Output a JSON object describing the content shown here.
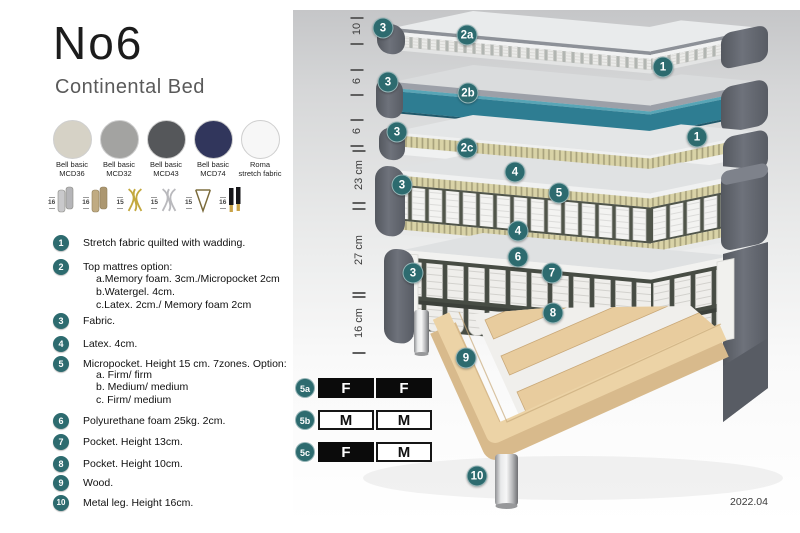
{
  "header": {
    "title": "No6",
    "subtitle": "Continental Bed"
  },
  "swatches": [
    {
      "name": "Bell basic\nMCD36",
      "color": "#d6d2c6",
      "dot": "rgba(255,255,255,0.6)"
    },
    {
      "name": "Bell basic\nMCD32",
      "color": "#a3a3a1",
      "dot": "rgba(255,255,255,0.5)"
    },
    {
      "name": "Bell basic\nMCD43",
      "color": "#55575a",
      "dot": "rgba(255,255,255,0.35)"
    },
    {
      "name": "Bell basic\nMCD74",
      "color": "#31365c",
      "dot": "rgba(255,255,255,0.3)"
    },
    {
      "name": "Roma\nstretch fabric",
      "color": "#f7f7f7",
      "dot": "rgba(220,220,220,0.5)"
    }
  ],
  "legs": [
    {
      "height": "16",
      "type": "cylinder-silver"
    },
    {
      "height": "16",
      "type": "cylinder-bronze"
    },
    {
      "height": "15",
      "type": "twist-gold"
    },
    {
      "height": "15",
      "type": "twist-silver"
    },
    {
      "height": "15",
      "type": "hairpin"
    },
    {
      "height": "16",
      "type": "cone-black-gold"
    }
  ],
  "features": [
    {
      "num": "1",
      "text": "Stretch fabric quilted with wadding.",
      "subs": []
    },
    {
      "num": "2",
      "text": "Top mattres option:",
      "subs": [
        "a.Memory foam. 3cm./Micropocket 2cm",
        "b.Watergel. 4cm.",
        "c.Latex. 2cm./ Memory foam 2cm"
      ]
    },
    {
      "num": "3",
      "text": "Fabric.",
      "subs": []
    },
    {
      "num": "4",
      "text": "Latex. 4cm.",
      "subs": []
    },
    {
      "num": "5",
      "text": "Micropocket. Height 15 cm. 7zones. Option:",
      "subs": [
        "a. Firm/ firm",
        "b. Medium/ medium",
        "c. Firm/ medium"
      ]
    },
    {
      "num": "6",
      "text": "Polyurethane foam 25kg. 2cm.",
      "subs": []
    },
    {
      "num": "7",
      "text": "Pocket. Height 13cm.",
      "subs": []
    },
    {
      "num": "8",
      "text": "Pocket. Height 10cm.",
      "subs": []
    },
    {
      "num": "9",
      "text": "Wood.",
      "subs": []
    },
    {
      "num": "10",
      "text": "Metal leg. Height 16cm.",
      "subs": []
    }
  ],
  "diagram": {
    "measurements": [
      "10",
      "6",
      "6",
      "23 cm",
      "27 cm",
      "16 cm"
    ],
    "layer_badges": [
      "3",
      "2a",
      "1",
      "3",
      "2b",
      "3",
      "2c",
      "1",
      "3",
      "4",
      "5",
      "4",
      "3",
      "6",
      "7",
      "8",
      "9",
      "10"
    ],
    "firmness_table": [
      {
        "row": "5a",
        "cells": [
          {
            "t": "F",
            "style": "dark"
          },
          {
            "t": "F",
            "style": "dark"
          }
        ]
      },
      {
        "row": "5b",
        "cells": [
          {
            "t": "M",
            "style": "light"
          },
          {
            "t": "M",
            "style": "light"
          }
        ]
      },
      {
        "row": "5c",
        "cells": [
          {
            "t": "F",
            "style": "dark"
          },
          {
            "t": "M",
            "style": "light"
          }
        ]
      }
    ],
    "version": "2022.04"
  },
  "colors": {
    "badge_teal": "#2d6b6f",
    "water_layer_teal": "#2e7d92",
    "upholstery_gray": "#63676f",
    "latex_beige": "#d9d3a7",
    "wood": "#e7cb9e"
  }
}
